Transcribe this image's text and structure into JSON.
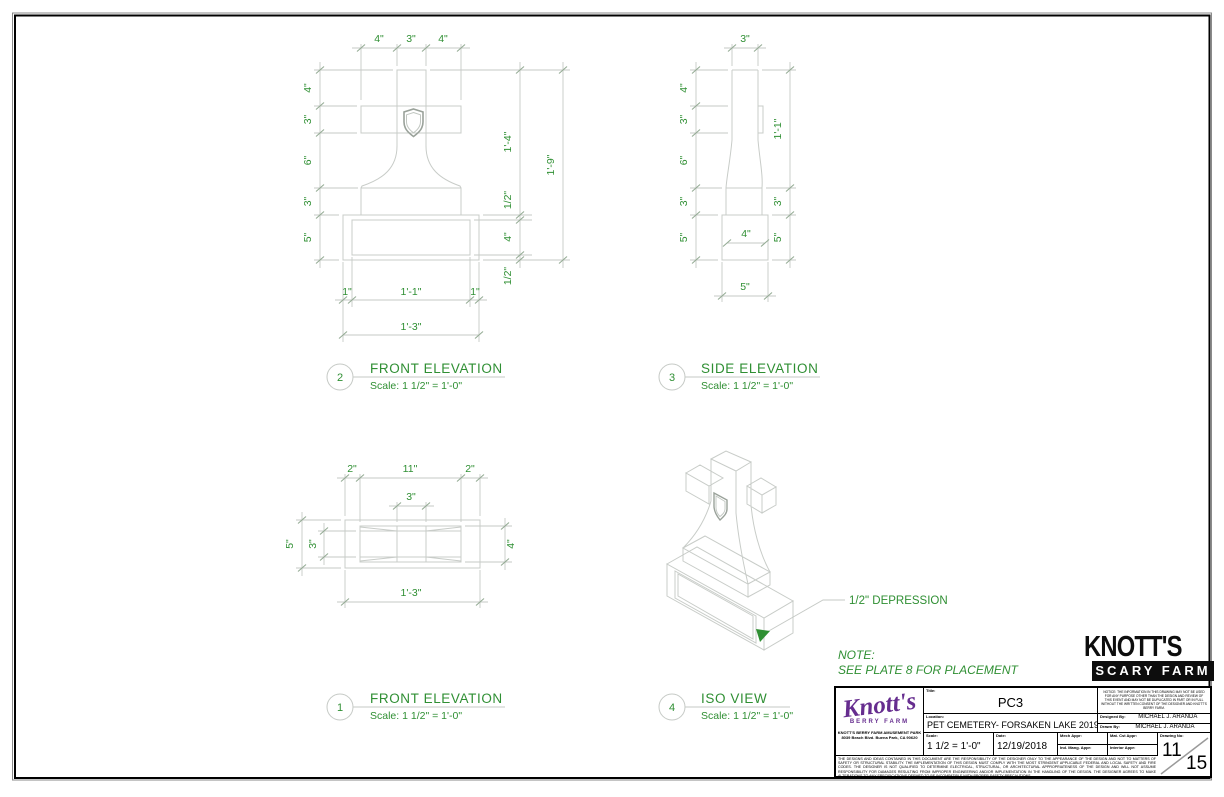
{
  "colors": {
    "dimension_text": "#2f8f33",
    "drawing_line": "#c8ccc8",
    "tick": "#95ac95",
    "logo_purple": "#662d8f"
  },
  "note": {
    "label": "NOTE:",
    "text": "SEE PLATE 8 FOR PLACEMENT"
  },
  "views": {
    "fe2": {
      "number": "2",
      "title": "FRONT ELEVATION",
      "scale_note": "Scale: 1 1/2\" = 1'-0\"",
      "dims": {
        "top": [
          "4\"",
          "3\"",
          "4\""
        ],
        "left": [
          "4\"",
          "3\"",
          "6\"",
          "3\"",
          "5\""
        ],
        "right": [
          "1'-4\"",
          "1'-9\"",
          "1/2\"",
          "4\"",
          "1/2\""
        ],
        "bottom": [
          "1\"",
          "1'-1\"",
          "1\"",
          "1'-3\""
        ]
      }
    },
    "se3": {
      "number": "3",
      "title": "SIDE ELEVATION",
      "scale_note": "Scale: 1 1/2\" = 1'-0\"",
      "dims": {
        "top": [
          "3\""
        ],
        "left": [
          "4\"",
          "3\"",
          "6\"",
          "3\"",
          "5\""
        ],
        "right": [
          "1'-1\"",
          "3\"",
          "5\""
        ],
        "base": [
          "4\""
        ],
        "bottom": [
          "5\""
        ]
      }
    },
    "fe1": {
      "number": "1",
      "title": "FRONT ELEVATION",
      "scale_note": "Scale: 1 1/2\" = 1'-0\"",
      "dims": {
        "top": [
          "2\"",
          "11\"",
          "2\"",
          "3\""
        ],
        "left": [
          "5\"",
          "3\""
        ],
        "right": [
          "4\""
        ],
        "bottom": [
          "1'-3\""
        ]
      }
    },
    "iso4": {
      "number": "4",
      "title": "ISO VIEW",
      "scale_note": "Scale: 1 1/2\" = 1'-0\"",
      "annotation": "1/2\" DEPRESSION"
    }
  },
  "scary_farm_logo": {
    "line1": "KNOTT'S",
    "line2": "SCARY FARM"
  },
  "title_block": {
    "logo": {
      "name": "Knott's",
      "subname": "BERRY FARM",
      "address_line1": "KNOTT'S BERRY FARM AMUSEMENT PARK",
      "address_line2": "8039 Beach Blvd.  Buena Park, CA 90620"
    },
    "title_label": "Title:",
    "title": "PC3",
    "location_label": "Location:",
    "location": "PET CEMETERY- FORSAKEN LAKE 2019",
    "scale_label": "Scale:",
    "scale": "1 1/2 = 1'-0\"",
    "date_label": "Date:",
    "date": "12/19/2018",
    "designed_by_label": "Designed By:",
    "designed_by": "MICHAEL J. ARANDA",
    "drawn_by_label": "Drawn By:",
    "drawn_by": "MICHAEL J. ARANDA",
    "approvals": [
      "Mech Appr:",
      "Mat. Cst Appr:",
      "Ind. Mang. Appr:",
      "Interior Appr:"
    ],
    "drawing_no_label": "Drawing No:",
    "sheet_number": "11",
    "sheet_total": "15",
    "notice": "NOTICE: THE INFORMATION IN THIS DRAWING MAY NOT BE USED FOR ANY PURPOSE OTHER THAN THE DESIGN AND REVIEW OF THIS EVENT AND MAY NOT BE DUPLICATED IN PART OR IN FULL WITHOUT THE WRITTEN CONSENT OF THE DESIGNER AND KNOTT'S BERRY FARM.",
    "disclaimer": "THE DESIGNS AND IDEAS CONTAINED IN THIS DOCUMENT ARE THE RESPONSIBILITY OF THE DESIGNER ONLY TO THE APPEARANCE OF THE DESIGN AND NOT TO MATTERS OF SAFETY OR STRUCTURAL STABILITY. THE IMPLEMENTATION OF THIS DESIGN MUST COMPLY WITH THE MOST STRINGENT APPLICABLE FEDERAL AND LOCAL SAFETY AND FIRE CODES. THE DESIGNER IS NOT QUALIFIED TO DETERMINE ELECTRICAL, STRUCTURAL, OR ARCHITECTURAL APPROPRIATENESS OF THE DESIGN AND WILL NOT ASSUME RESPONSIBILITY FOR DAMAGES RESULTING FROM IMPROPER ENGINEERING AND/OR IMPLEMENTATION IN THE HANDLING OF THE DESIGN. THE DESIGNER AGREES TO MAKE ALTERATIONS TO ANY SPECIFICATIONS DEEMED TO BE INCOMPATIBLE WITH PROPER SAFETY PRECAUTIONS."
  }
}
